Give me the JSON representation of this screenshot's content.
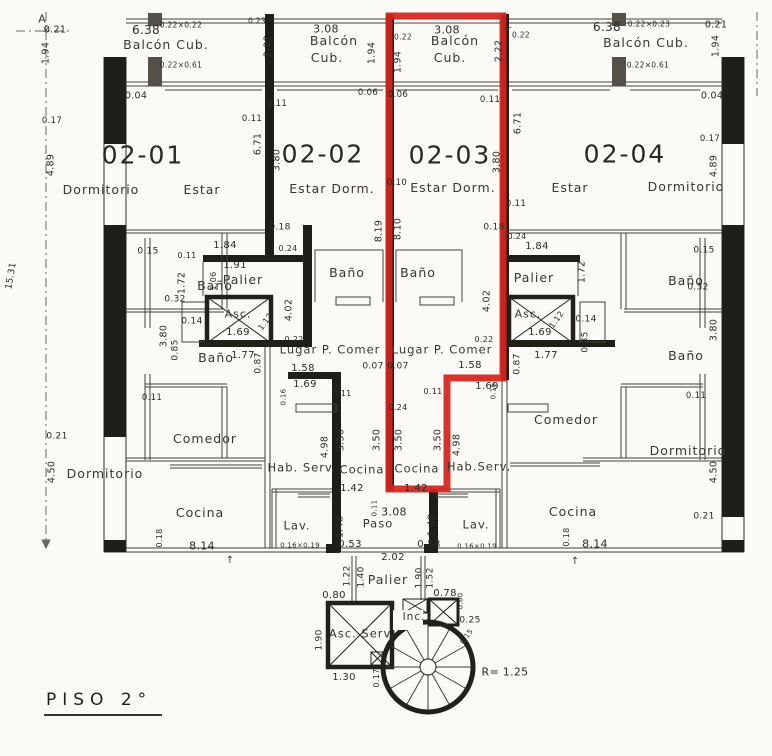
{
  "plan": {
    "title": "PISO 2°",
    "floor_label": "PISO 2°",
    "units": [
      "02-01",
      "02-02",
      "02-03",
      "02-04"
    ],
    "highlighted_unit": "02-03",
    "highlight_color": "#d4231d",
    "ink_color": "#2e2b26",
    "stair_radius_label": "R= 1.25",
    "overall_dimension": "15.31",
    "labels": [
      {
        "t": "02-01",
        "x": 143,
        "y": 155,
        "k": "unit"
      },
      {
        "t": "02-02",
        "x": 323,
        "y": 154,
        "k": "unit"
      },
      {
        "t": "02-03",
        "x": 450,
        "y": 155,
        "k": "unit"
      },
      {
        "t": "02-04",
        "x": 625,
        "y": 154,
        "k": "unit"
      },
      {
        "t": "Balcón Cub.",
        "x": 166,
        "y": 45,
        "k": "room"
      },
      {
        "t": "Balcón",
        "x": 334,
        "y": 41,
        "k": "room"
      },
      {
        "t": "Cub.",
        "x": 327,
        "y": 58,
        "k": "room"
      },
      {
        "t": "Balcón",
        "x": 455,
        "y": 41,
        "k": "room"
      },
      {
        "t": "Cub.",
        "x": 450,
        "y": 58,
        "k": "room"
      },
      {
        "t": "Balcón Cub.",
        "x": 646,
        "y": 43,
        "k": "room"
      },
      {
        "t": "Dormitorio",
        "x": 101,
        "y": 190,
        "k": "room"
      },
      {
        "t": "Estar",
        "x": 202,
        "y": 190,
        "k": "room"
      },
      {
        "t": "Estar Dorm.",
        "x": 332,
        "y": 189,
        "k": "room"
      },
      {
        "t": "Estar Dorm.",
        "x": 453,
        "y": 188,
        "k": "room"
      },
      {
        "t": "Estar",
        "x": 570,
        "y": 188,
        "k": "room"
      },
      {
        "t": "Dormitorio",
        "x": 686,
        "y": 187,
        "k": "room"
      },
      {
        "t": "Baño",
        "x": 215,
        "y": 286,
        "k": "room"
      },
      {
        "t": "Baño",
        "x": 216,
        "y": 358,
        "k": "room"
      },
      {
        "t": "Baño",
        "x": 347,
        "y": 273,
        "k": "room"
      },
      {
        "t": "Baño",
        "x": 418,
        "y": 273,
        "k": "room"
      },
      {
        "t": "Baño",
        "x": 686,
        "y": 281,
        "k": "room"
      },
      {
        "t": "Baño",
        "x": 686,
        "y": 356,
        "k": "room"
      },
      {
        "t": "Palier",
        "x": 243,
        "y": 280,
        "k": "room"
      },
      {
        "t": "Palier",
        "x": 534,
        "y": 278,
        "k": "room"
      },
      {
        "t": "Asc.",
        "x": 238,
        "y": 314,
        "k": "room",
        "s": 11
      },
      {
        "t": "Asc.",
        "x": 528,
        "y": 314,
        "k": "room",
        "s": 11
      },
      {
        "t": "Lugar P. Comer",
        "x": 330,
        "y": 350,
        "k": "room",
        "s": 11.5
      },
      {
        "t": "Lugar P. Comer",
        "x": 442,
        "y": 350,
        "k": "room",
        "s": 11.5
      },
      {
        "t": "Comedor",
        "x": 205,
        "y": 439,
        "k": "room"
      },
      {
        "t": "Comedor",
        "x": 566,
        "y": 420,
        "k": "room"
      },
      {
        "t": "Dormitorio",
        "x": 105,
        "y": 474,
        "k": "room"
      },
      {
        "t": "Dormitorio",
        "x": 688,
        "y": 451,
        "k": "room"
      },
      {
        "t": "Hab. Serv.",
        "x": 302,
        "y": 468,
        "k": "room",
        "s": 11.5
      },
      {
        "t": "Hab.Serv.",
        "x": 479,
        "y": 467,
        "k": "room",
        "s": 11.5
      },
      {
        "t": "Cocina",
        "x": 362,
        "y": 470,
        "k": "room",
        "s": 11.5
      },
      {
        "t": "Cocina",
        "x": 417,
        "y": 469,
        "k": "room",
        "s": 11.5
      },
      {
        "t": "Cocina",
        "x": 200,
        "y": 513,
        "k": "room"
      },
      {
        "t": "Cocina",
        "x": 573,
        "y": 512,
        "k": "room"
      },
      {
        "t": "Lav.",
        "x": 297,
        "y": 526,
        "k": "room",
        "s": 11.5
      },
      {
        "t": "Lav.",
        "x": 476,
        "y": 525,
        "k": "room",
        "s": 11.5
      },
      {
        "t": "Paso",
        "x": 378,
        "y": 524,
        "k": "room",
        "s": 11.5
      },
      {
        "t": "Palier",
        "x": 388,
        "y": 580,
        "k": "room"
      },
      {
        "t": "Asc. Serv.",
        "x": 362,
        "y": 634,
        "k": "room",
        "s": 11.5
      },
      {
        "t": "Inc.",
        "x": 414,
        "y": 617,
        "k": "room",
        "s": 10.5
      },
      {
        "t": "0.21",
        "x": 55,
        "y": 30
      },
      {
        "t": "1.94",
        "x": 46,
        "y": 53,
        "r": -90
      },
      {
        "t": "6.38",
        "x": 146,
        "y": 30,
        "s": 12
      },
      {
        "t": "0.22×0.22",
        "x": 181,
        "y": 25,
        "s": 7.5
      },
      {
        "t": "0.22×0.61",
        "x": 181,
        "y": 65,
        "s": 7.5
      },
      {
        "t": "0.04",
        "x": 136,
        "y": 96
      },
      {
        "t": "0.23",
        "x": 257,
        "y": 21,
        "s": 7.5
      },
      {
        "t": "2.22",
        "x": 268,
        "y": 46,
        "r": -90
      },
      {
        "t": "3.08",
        "x": 326,
        "y": 29,
        "s": 11
      },
      {
        "t": "1.94",
        "x": 372,
        "y": 53,
        "r": -90
      },
      {
        "t": "0.22",
        "x": 403,
        "y": 37,
        "s": 7.5
      },
      {
        "t": "1.94",
        "x": 398,
        "y": 62,
        "r": -90
      },
      {
        "t": "3.08",
        "x": 447,
        "y": 30,
        "s": 11
      },
      {
        "t": "2.22",
        "x": 499,
        "y": 51,
        "r": -90
      },
      {
        "t": "0.22",
        "x": 521,
        "y": 35,
        "s": 7.5
      },
      {
        "t": "6.38",
        "x": 607,
        "y": 27,
        "s": 12
      },
      {
        "t": "0.22×0.23",
        "x": 649,
        "y": 24,
        "s": 7.5
      },
      {
        "t": "0.22×0.61",
        "x": 648,
        "y": 65,
        "s": 7.5
      },
      {
        "t": "0.21",
        "x": 716,
        "y": 25
      },
      {
        "t": "1.94",
        "x": 716,
        "y": 46,
        "r": -90
      },
      {
        "t": "0.04",
        "x": 712,
        "y": 96
      },
      {
        "t": "0.06",
        "x": 368,
        "y": 93,
        "s": 8.5
      },
      {
        "t": "0.06",
        "x": 398,
        "y": 95,
        "s": 8.5
      },
      {
        "t": "0.11",
        "x": 490,
        "y": 100,
        "s": 8.5
      },
      {
        "t": "0.11",
        "x": 277,
        "y": 104,
        "s": 8.5
      },
      {
        "t": "0.17",
        "x": 52,
        "y": 121,
        "s": 8.5
      },
      {
        "t": "4.89",
        "x": 51,
        "y": 165,
        "r": -90
      },
      {
        "t": "0.11",
        "x": 252,
        "y": 119,
        "s": 8.5
      },
      {
        "t": "6.71",
        "x": 258,
        "y": 144,
        "r": -90
      },
      {
        "t": "3.80",
        "x": 277,
        "y": 160,
        "r": -90
      },
      {
        "t": "0.10",
        "x": 397,
        "y": 183,
        "s": 8.5
      },
      {
        "t": "6.71",
        "x": 518,
        "y": 123,
        "r": -90
      },
      {
        "t": "3.80",
        "x": 497,
        "y": 162,
        "r": -90
      },
      {
        "t": "0.11",
        "x": 516,
        "y": 204,
        "s": 8.5
      },
      {
        "t": "0.17",
        "x": 710,
        "y": 139,
        "s": 8.5
      },
      {
        "t": "4.89",
        "x": 714,
        "y": 166,
        "r": -90
      },
      {
        "t": "15.31",
        "x": 12,
        "y": 276,
        "r": -80,
        "s": 9
      },
      {
        "t": "0.15",
        "x": 148,
        "y": 252,
        "s": 9
      },
      {
        "t": "0.32",
        "x": 175,
        "y": 300,
        "s": 9
      },
      {
        "t": "3.80",
        "x": 164,
        "y": 336,
        "r": -90
      },
      {
        "t": "0.11",
        "x": 152,
        "y": 398,
        "s": 8.5
      },
      {
        "t": "0.21",
        "x": 57,
        "y": 437,
        "s": 9
      },
      {
        "t": "4.50",
        "x": 52,
        "y": 472,
        "r": -90
      },
      {
        "t": "0.15",
        "x": 704,
        "y": 251,
        "s": 9
      },
      {
        "t": "0.32",
        "x": 698,
        "y": 288,
        "s": 9
      },
      {
        "t": "3.80",
        "x": 714,
        "y": 330,
        "r": -90
      },
      {
        "t": "0.11",
        "x": 696,
        "y": 396,
        "s": 8.5
      },
      {
        "t": "0.21",
        "x": 704,
        "y": 517,
        "s": 9
      },
      {
        "t": "4.50",
        "x": 714,
        "y": 472,
        "r": -90
      },
      {
        "t": "0.18",
        "x": 280,
        "y": 228,
        "s": 9
      },
      {
        "t": "1.84",
        "x": 225,
        "y": 246,
        "s": 10
      },
      {
        "t": "0.24",
        "x": 288,
        "y": 249,
        "s": 8
      },
      {
        "t": "0.11",
        "x": 187,
        "y": 256,
        "s": 8
      },
      {
        "t": "1.91",
        "x": 235,
        "y": 266,
        "s": 10
      },
      {
        "t": "1.72",
        "x": 182,
        "y": 283,
        "r": -90
      },
      {
        "t": "1.06",
        "x": 214,
        "y": 281,
        "r": -90,
        "s": 8
      },
      {
        "t": "4.02",
        "x": 289,
        "y": 310,
        "r": -90
      },
      {
        "t": "0.14",
        "x": 192,
        "y": 322,
        "s": 9
      },
      {
        "t": "1.12",
        "x": 266,
        "y": 322,
        "r": -55,
        "s": 8
      },
      {
        "t": "1.69",
        "x": 238,
        "y": 333,
        "s": 10
      },
      {
        "t": "0.22",
        "x": 294,
        "y": 340,
        "s": 8
      },
      {
        "t": "0.85",
        "x": 176,
        "y": 350,
        "r": -90,
        "s": 9
      },
      {
        "t": "1.77",
        "x": 243,
        "y": 356,
        "s": 10
      },
      {
        "t": "0.87",
        "x": 259,
        "y": 363,
        "r": -90,
        "s": 9
      },
      {
        "t": "0.18",
        "x": 494,
        "y": 228,
        "s": 9
      },
      {
        "t": "0.24",
        "x": 517,
        "y": 237,
        "s": 8
      },
      {
        "t": "1.84",
        "x": 537,
        "y": 247,
        "s": 10
      },
      {
        "t": "1.72",
        "x": 582,
        "y": 272,
        "r": -90
      },
      {
        "t": "4.02",
        "x": 487,
        "y": 301,
        "r": -90
      },
      {
        "t": "1.12",
        "x": 557,
        "y": 320,
        "r": -55,
        "s": 8
      },
      {
        "t": "0.14",
        "x": 586,
        "y": 320,
        "s": 9
      },
      {
        "t": "1.69",
        "x": 540,
        "y": 333,
        "s": 10
      },
      {
        "t": "0.22",
        "x": 484,
        "y": 340,
        "s": 8
      },
      {
        "t": "0.85",
        "x": 586,
        "y": 342,
        "r": -90,
        "s": 9
      },
      {
        "t": "1.77",
        "x": 546,
        "y": 356,
        "s": 10
      },
      {
        "t": "0.87",
        "x": 518,
        "y": 364,
        "r": -90,
        "s": 9
      },
      {
        "t": "8.19",
        "x": 379,
        "y": 231,
        "r": -90
      },
      {
        "t": "8.10",
        "x": 398,
        "y": 229,
        "r": -90
      },
      {
        "t": "1.58",
        "x": 303,
        "y": 369,
        "s": 10
      },
      {
        "t": "0.07",
        "x": 373,
        "y": 367,
        "s": 9
      },
      {
        "t": "0.07",
        "x": 398,
        "y": 367,
        "s": 9
      },
      {
        "t": "1.58",
        "x": 470,
        "y": 366,
        "s": 10
      },
      {
        "t": "1.69",
        "x": 305,
        "y": 385,
        "s": 10
      },
      {
        "t": "1.69",
        "x": 487,
        "y": 387,
        "s": 10
      },
      {
        "t": "0.16",
        "x": 284,
        "y": 397,
        "r": -90,
        "s": 7
      },
      {
        "t": "0.16",
        "x": 494,
        "y": 391,
        "r": -90,
        "s": 7
      },
      {
        "t": "0.11",
        "x": 342,
        "y": 394,
        "s": 8
      },
      {
        "t": "0.11",
        "x": 433,
        "y": 392,
        "s": 8
      },
      {
        "t": "0.24",
        "x": 398,
        "y": 408,
        "s": 8
      },
      {
        "t": "3.50",
        "x": 341,
        "y": 440,
        "r": -90
      },
      {
        "t": "3.50",
        "x": 377,
        "y": 440,
        "r": -90
      },
      {
        "t": "3.50",
        "x": 399,
        "y": 440,
        "r": -90
      },
      {
        "t": "3.50",
        "x": 438,
        "y": 440,
        "r": -90
      },
      {
        "t": "4.98",
        "x": 325,
        "y": 447,
        "r": -90
      },
      {
        "t": "4.98",
        "x": 457,
        "y": 445,
        "r": -90
      },
      {
        "t": "1.42",
        "x": 352,
        "y": 489,
        "s": 10
      },
      {
        "t": "1.42",
        "x": 416,
        "y": 489,
        "s": 10
      },
      {
        "t": "0.11",
        "x": 375,
        "y": 508,
        "r": -90,
        "s": 7
      },
      {
        "t": "3.08",
        "x": 394,
        "y": 512,
        "s": 11
      },
      {
        "t": "1.48",
        "x": 340,
        "y": 527,
        "r": -90
      },
      {
        "t": "1.48",
        "x": 432,
        "y": 525,
        "r": -90
      },
      {
        "t": "0.53",
        "x": 350,
        "y": 545,
        "s": 10
      },
      {
        "t": "0.53",
        "x": 429,
        "y": 545,
        "s": 10
      },
      {
        "t": "0.16×0.19",
        "x": 300,
        "y": 546,
        "s": 7
      },
      {
        "t": "0.16×0.19",
        "x": 477,
        "y": 547,
        "s": 7
      },
      {
        "t": "0.18",
        "x": 160,
        "y": 538,
        "r": -90,
        "s": 8
      },
      {
        "t": "8.14",
        "x": 202,
        "y": 546,
        "s": 11
      },
      {
        "t": "0.18",
        "x": 567,
        "y": 537,
        "r": -90,
        "s": 8
      },
      {
        "t": "8.14",
        "x": 595,
        "y": 544,
        "s": 11
      },
      {
        "t": "2.02",
        "x": 393,
        "y": 558,
        "s": 10
      },
      {
        "t": "1.22",
        "x": 348,
        "y": 576,
        "r": -90,
        "s": 9
      },
      {
        "t": "1.40",
        "x": 362,
        "y": 577,
        "r": -90,
        "s": 9
      },
      {
        "t": "1.90",
        "x": 420,
        "y": 578,
        "r": -90,
        "s": 9
      },
      {
        "t": "1.52",
        "x": 431,
        "y": 578,
        "r": -90,
        "s": 9
      },
      {
        "t": "0.80",
        "x": 334,
        "y": 596,
        "s": 10
      },
      {
        "t": "0.78",
        "x": 445,
        "y": 594,
        "s": 10
      },
      {
        "t": "0.60",
        "x": 461,
        "y": 601,
        "r": -90,
        "s": 7
      },
      {
        "t": "0.25",
        "x": 470,
        "y": 621,
        "s": 9
      },
      {
        "t": "0.15",
        "x": 467,
        "y": 637,
        "r": -55,
        "s": 7
      },
      {
        "t": "1.90",
        "x": 320,
        "y": 640,
        "r": -90,
        "s": 9
      },
      {
        "t": "1.30",
        "x": 344,
        "y": 678,
        "s": 10
      },
      {
        "t": "0.17",
        "x": 377,
        "y": 678,
        "r": -90,
        "s": 8
      },
      {
        "t": "R= 1.25",
        "x": 505,
        "y": 672,
        "s": 11
      },
      {
        "t": "A",
        "x": 42,
        "y": 19,
        "k": "mark",
        "s": 11
      },
      {
        "t": "×",
        "x": 46,
        "y": 31,
        "k": "mark",
        "s": 9
      },
      {
        "t": "↑",
        "x": 230,
        "y": 561,
        "k": "mark",
        "s": 10
      },
      {
        "t": "↑",
        "x": 575,
        "y": 562,
        "k": "mark",
        "s": 10
      },
      {
        "t": "←",
        "x": 508,
        "y": 29,
        "k": "mark",
        "s": 9
      }
    ]
  }
}
